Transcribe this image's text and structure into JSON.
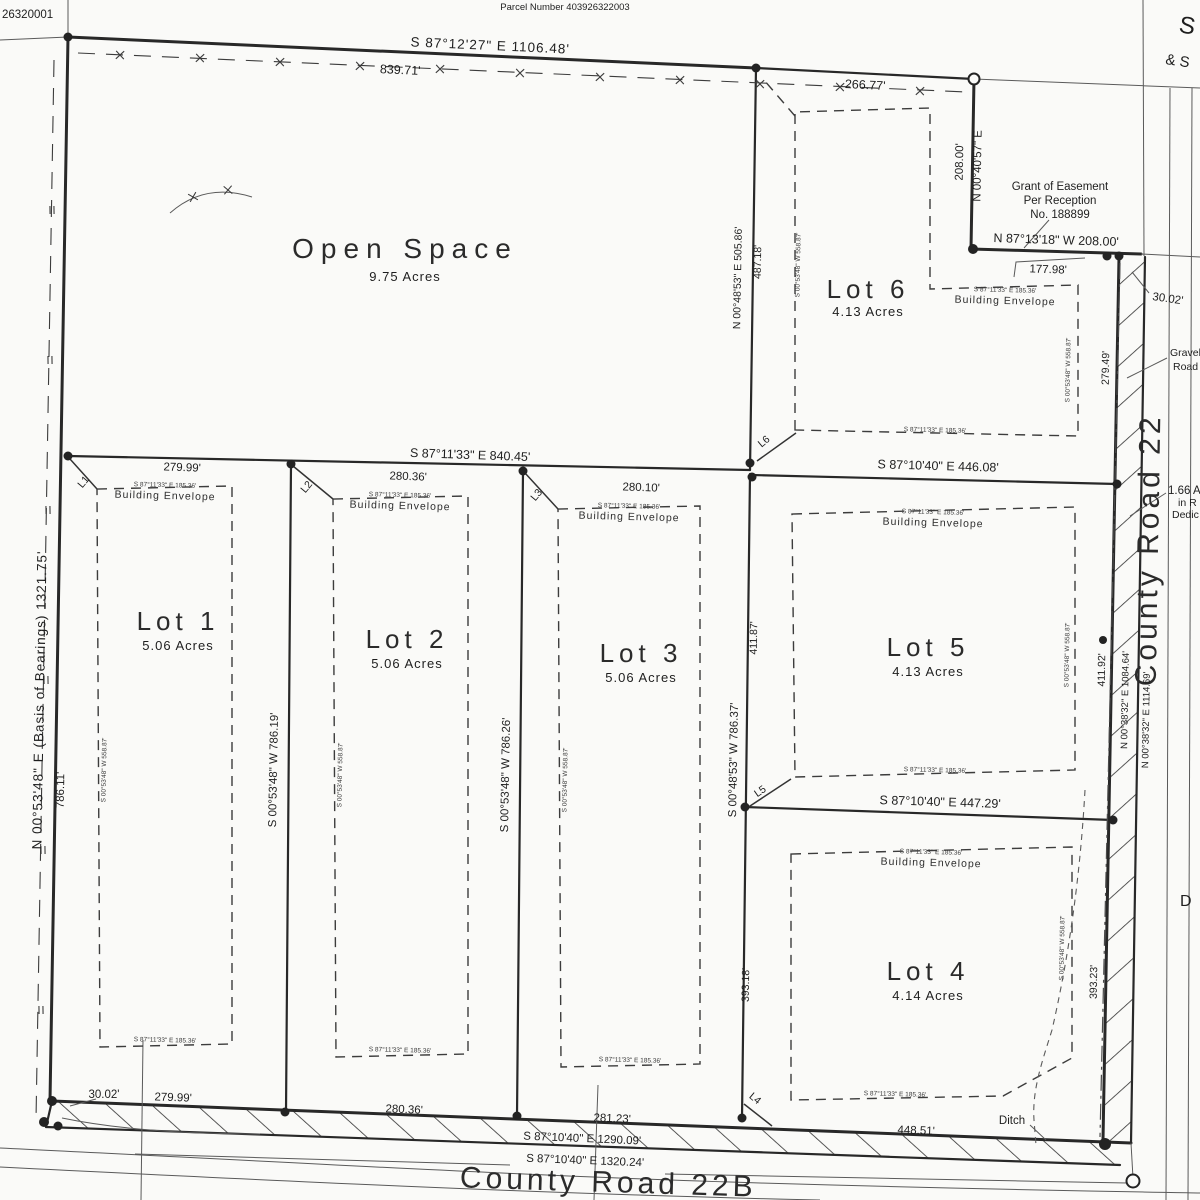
{
  "sheet": {
    "corner_text": "26320001",
    "parcel_number": "Parcel Number 403926322003",
    "edge_text_1": "S",
    "edge_text_2": "& S",
    "edge_text_d": "D"
  },
  "lots": {
    "open_space": {
      "name": "Open Space",
      "acres": "9.75 Acres"
    },
    "lot1": {
      "name": "Lot 1",
      "acres": "5.06 Acres"
    },
    "lot2": {
      "name": "Lot 2",
      "acres": "5.06 Acres"
    },
    "lot3": {
      "name": "Lot 3",
      "acres": "5.06 Acres"
    },
    "lot4": {
      "name": "Lot 4",
      "acres": "4.14 Acres"
    },
    "lot5": {
      "name": "Lot 5",
      "acres": "4.13 Acres"
    },
    "lot6": {
      "name": "Lot 6",
      "acres": "4.13 Acres"
    }
  },
  "envelope": {
    "label": "Building Envelope",
    "dim_h": "S 87°11'33\" E  185.36'",
    "dim_v": "S 00°53'48\" W  558.87'"
  },
  "easement": {
    "line1": "Grant of Easement",
    "line2": "Per Reception",
    "line3": "No. 188899"
  },
  "roads": {
    "county_road_22": "County Road 22",
    "county_road_22b": "County Road 22B",
    "gravel_1": "Gravel",
    "gravel_2": "Road",
    "ditch": "Ditch"
  },
  "dedication": {
    "line1": "1.66 A",
    "line2": "in R",
    "line3": "Dedic"
  },
  "dims": {
    "top_bearing": "S 87°12'27\" E  1106.48'",
    "top_seg1": "839.71'",
    "top_seg2": "266.77'",
    "left_bearing": "N 00°53'48\" E  (Basis of Bearings)  1321.75'",
    "left_seg": "786.11'",
    "ne_dist": "208.00'",
    "ne_bearing": "N 00°40'57\" E",
    "easement_bearing": "N 87°13'18\" W   208.00'",
    "easement_seg": "177.98'",
    "jog_top": "30.02'",
    "jog_bottom": "30.02'",
    "mid_bearing": "S 87°11'33\" E  840.45'",
    "mid_seg1": "279.99'",
    "mid_seg2": "280.36'",
    "mid_seg3": "280.10'",
    "lot56_bearing": "S 87°10'40\" E  446.08'",
    "lot54_bearing": "S 87°10'40\" E  447.29'",
    "d12": "S 00°53'48\" W  786.19'",
    "d23": "S 00°53'48\" W  786.26'",
    "d6_bearing": "N 00°48'53\" E  505.86'",
    "d6_seg": "487.18'",
    "d345": "S 00°48'53\" W  786.37'",
    "d345_up": "411.87'",
    "d345_dn": "393.18'",
    "road_279": "279.49'",
    "road_411": "411.92'",
    "road_1084": "N 00°38'32\" E  1084.64'",
    "road_1114": "N 00°38'32\" E  1114.69'",
    "road_393": "393.23'",
    "bot_seg1": "279.99'",
    "bot_seg2": "280.36'",
    "bot_seg3": "281.23'",
    "bot_seg4": "448.51'",
    "bot_bearing1": "S 87°10'40\" E  1290.09'",
    "bot_bearing2": "S 87°10'40\" E  1320.24'"
  },
  "line_labels": {
    "l1": "L1",
    "l2": "L2",
    "l3": "L3",
    "l4": "L4",
    "l5": "L5",
    "l6": "L6"
  }
}
